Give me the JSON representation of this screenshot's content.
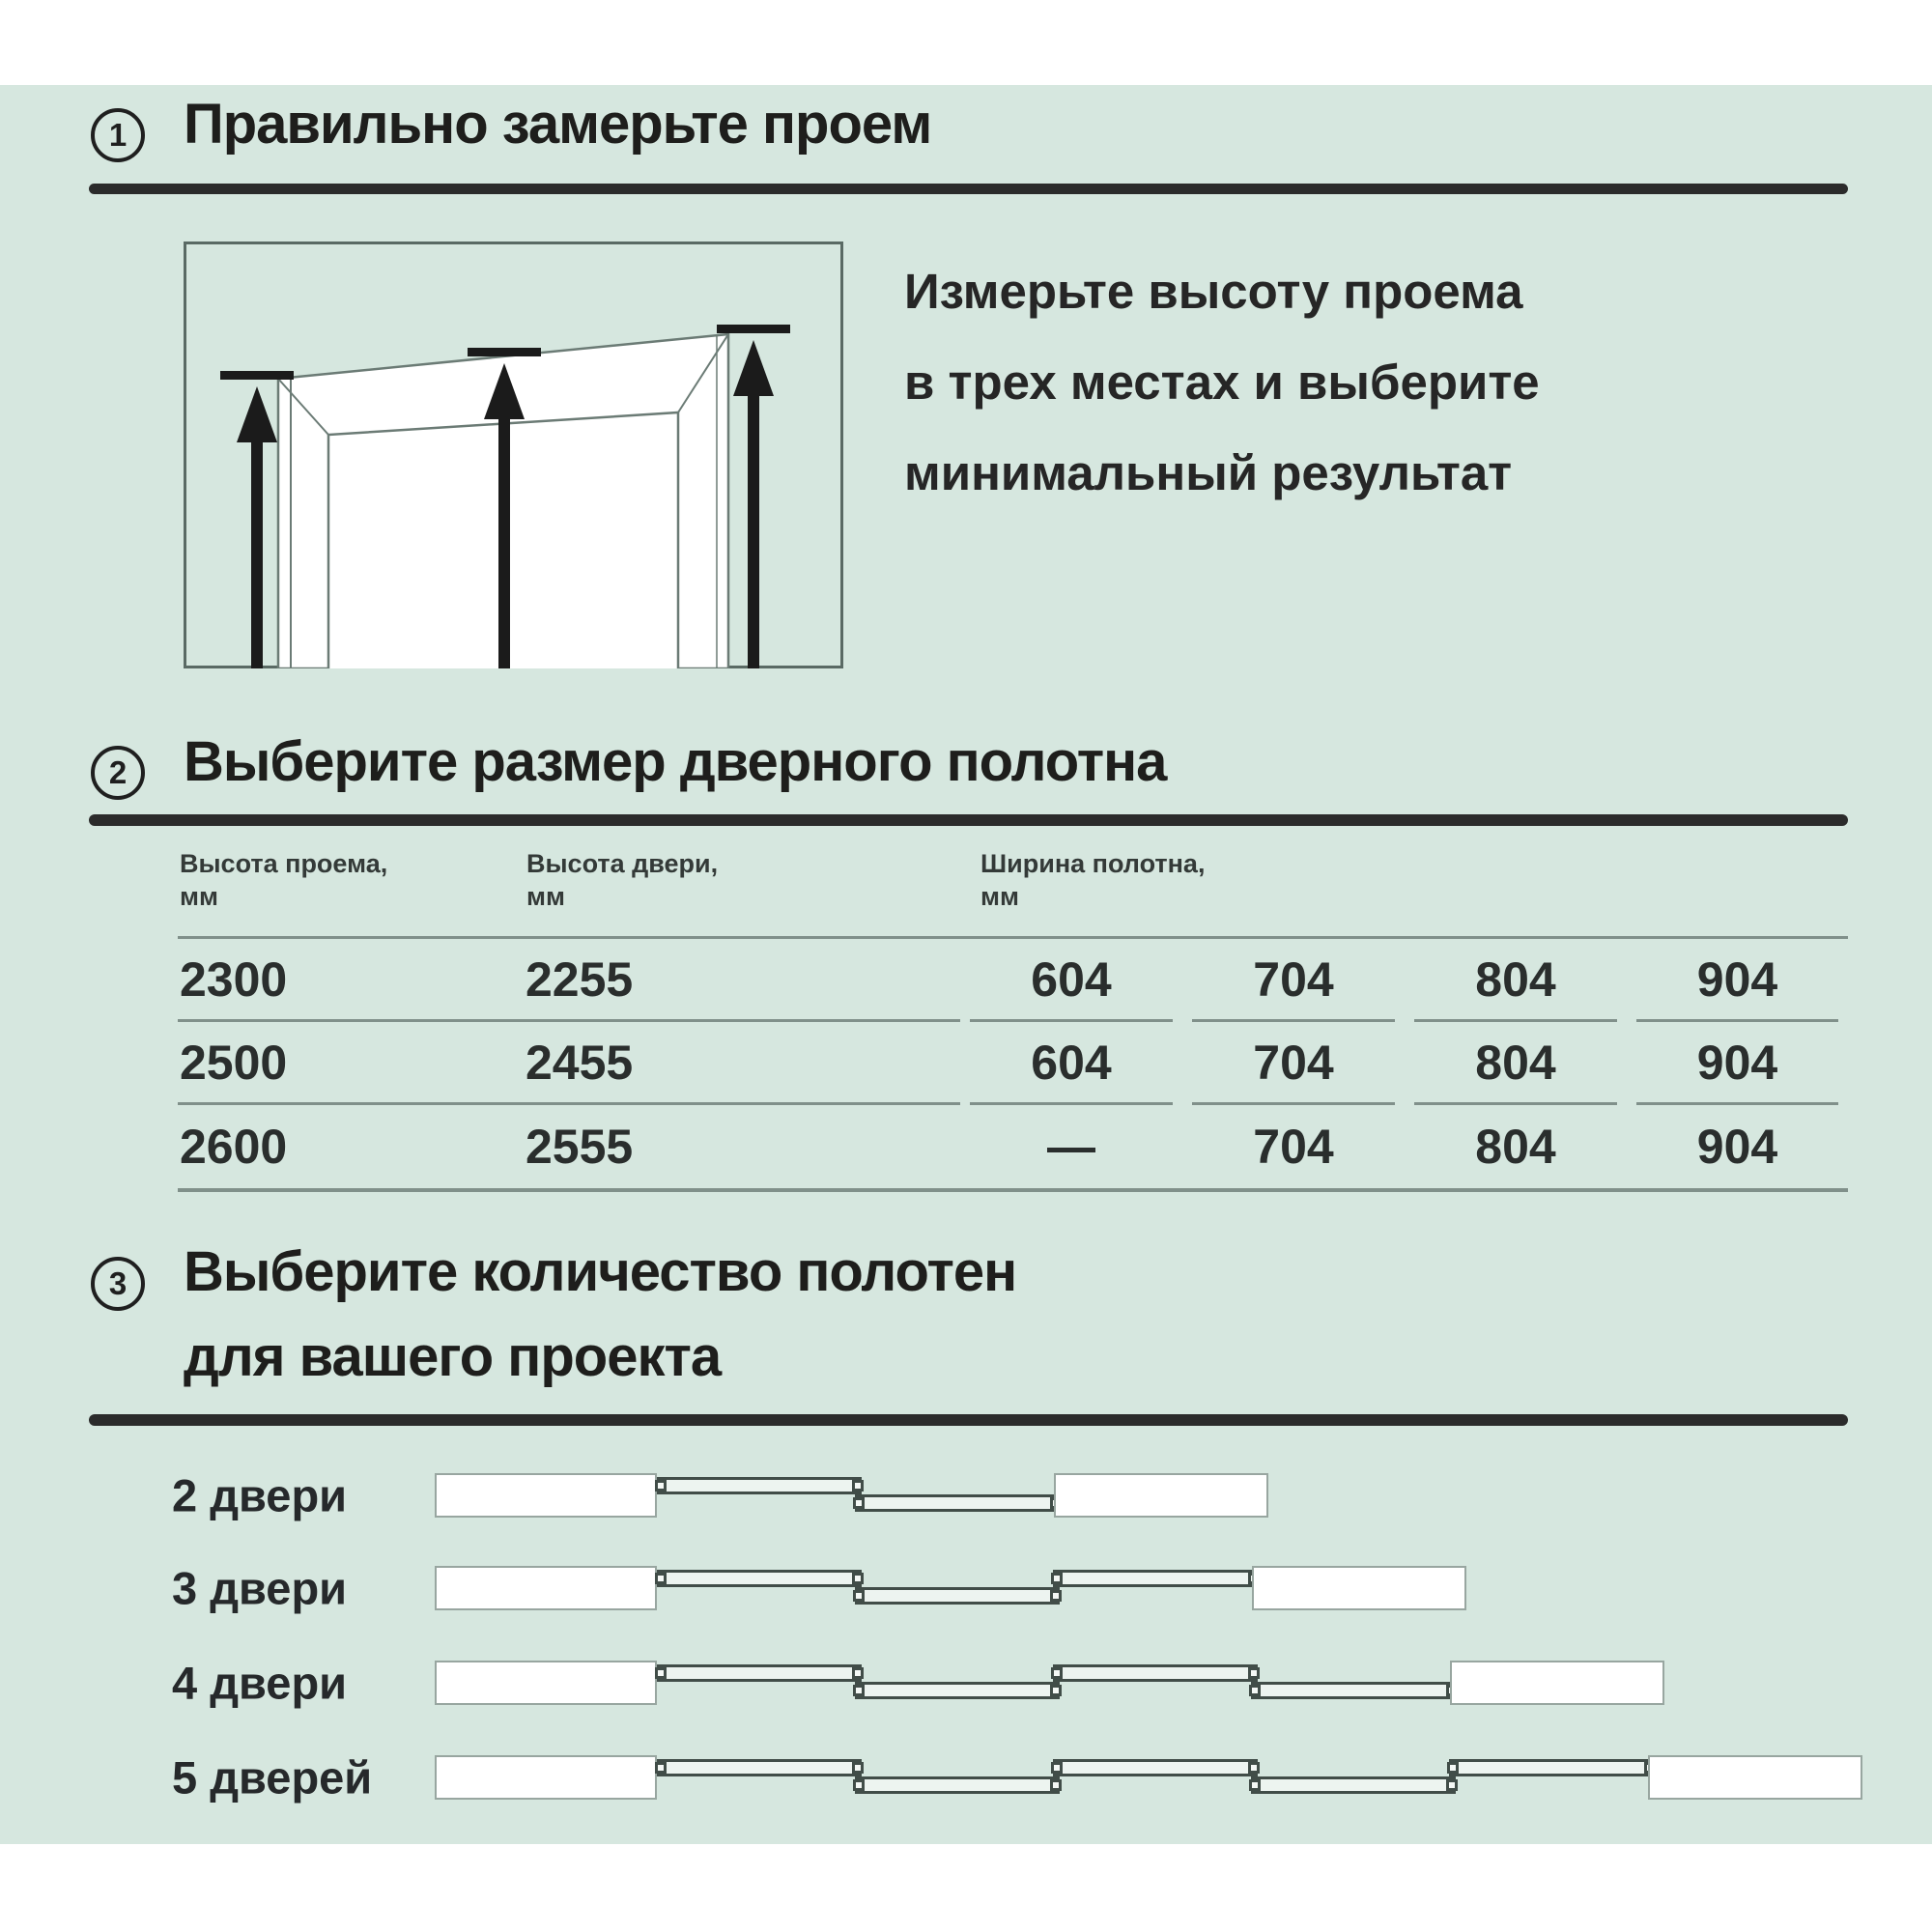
{
  "colors": {
    "background_green": "#d6e7df",
    "ink": "#1e1e1c",
    "rule_gray": "#80908a",
    "underline_dark": "#2b2b2b"
  },
  "section1": {
    "number": "1",
    "title": "Правильно замерьте проем",
    "description_lines": [
      "Измерьте высоту проема",
      "в трех местах и выберите",
      "минимальный результат"
    ]
  },
  "section2": {
    "number": "2",
    "title": "Выберите размер дверного полотна",
    "table": {
      "headers": [
        {
          "line1": "Высота проема,",
          "line2": "мм"
        },
        {
          "line1": "Высота двери,",
          "line2": "мм"
        },
        {
          "line1": "Ширина полотна,",
          "line2": "мм"
        }
      ],
      "rows": [
        {
          "opening_height": "2300",
          "door_height": "2255",
          "widths": [
            "604",
            "704",
            "804",
            "904"
          ]
        },
        {
          "opening_height": "2500",
          "door_height": "2455",
          "widths": [
            "604",
            "704",
            "804",
            "904"
          ]
        },
        {
          "opening_height": "2600",
          "door_height": "2555",
          "widths": [
            "—",
            "704",
            "804",
            "904"
          ]
        }
      ]
    }
  },
  "section3": {
    "number": "3",
    "title_lines": [
      "Выберите количество полотен",
      "для вашего проекта"
    ],
    "options": [
      {
        "label": "2 двери",
        "doors": 2
      },
      {
        "label": "3 двери",
        "doors": 3
      },
      {
        "label": "4 двери",
        "doors": 4
      },
      {
        "label": "5 дверей",
        "doors": 5
      }
    ]
  }
}
